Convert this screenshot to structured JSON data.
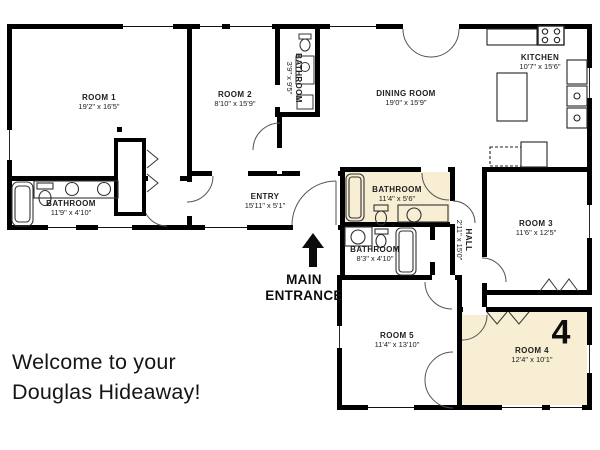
{
  "plan": {
    "rooms": {
      "room1": {
        "name": "ROOM 1",
        "dims": "19'2\" x 16'5\""
      },
      "room2": {
        "name": "ROOM 2",
        "dims": "8'10\" x 15'9\""
      },
      "bathroom_top": {
        "name": "BATHROOM",
        "dims": "3'9\" x 9'5\""
      },
      "dining_room": {
        "name": "DINING ROOM",
        "dims": "19'0\" x 15'9\""
      },
      "kitchen": {
        "name": "KITCHEN",
        "dims": "10'7\" x 15'6\""
      },
      "bathroom_left": {
        "name": "BATHROOM",
        "dims": "11'9\" x 4'10\""
      },
      "entry": {
        "name": "ENTRY",
        "dims": "15'11\" x 5'1\""
      },
      "bathroom_highlight": {
        "name": "BATHROOM",
        "dims": "11'4\" x 5'6\""
      },
      "bathroom_mid": {
        "name": "BATHROOM",
        "dims": "8'3\" x 4'10\""
      },
      "hall": {
        "name": "HALL",
        "dims": "2'11\" x 15'0\""
      },
      "room3": {
        "name": "ROOM 3",
        "dims": "11'6\" x 12'5\""
      },
      "room5": {
        "name": "ROOM 5",
        "dims": "11'4\" x 13'10\""
      },
      "room4": {
        "name": "ROOM 4",
        "dims": "12'4\" x 10'1\""
      }
    },
    "entrance": {
      "line1": "MAIN",
      "line2": "ENTRANCE"
    },
    "unit_number": "4"
  },
  "welcome": {
    "line1": "Welcome to your",
    "line2": "Douglas Hideaway!"
  },
  "colors": {
    "highlight": "#f7eed3",
    "wall": "#000000",
    "canvas": "#ffffff"
  }
}
